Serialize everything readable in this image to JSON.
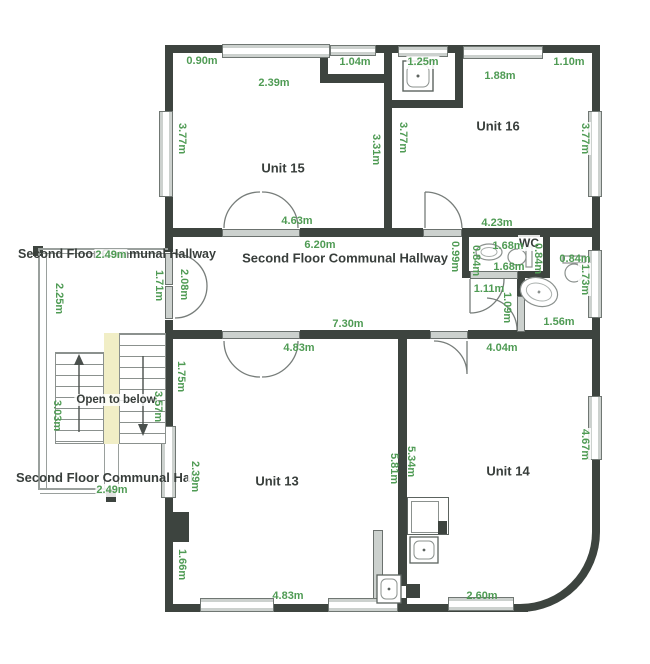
{
  "labels": {
    "unit15": "Unit 15",
    "unit16": "Unit 16",
    "unit13": "Unit 13",
    "unit14": "Unit 14",
    "hallway_main": "Second Floor Communal Hallway",
    "hallway_left_top": "Second Floor Communal Hallway",
    "hallway_left_bottom": "Second Floor Communal Hallway",
    "wc": "WC",
    "open_to_below": "Open to below"
  },
  "measurements": {
    "unit15_top_left": "0.90m",
    "unit15_top_window": "2.39m",
    "unit15_alcove": "1.04m",
    "unit15_left": "3.77m",
    "unit15_right": "3.31m",
    "unit15_door": "4.63m",
    "unit16_alcove": "1.25m",
    "unit16_top_window": "1.88m",
    "unit16_top_right": "1.10m",
    "unit16_left": "3.77m",
    "unit16_right": "3.77m",
    "unit16_bottom": "4.23m",
    "hallway_top": "6.20m",
    "hallway_bottom": "7.30m",
    "annex_top": "2.49m",
    "annex_left": "2.25m",
    "annex_right": "1.71m",
    "annex_door": "2.08m",
    "stairs_left": "3.03m",
    "stairs_right": "3.57m",
    "annex_bottom": "2.49m",
    "wc_outside": "0.99m",
    "wc_top": "1.68m",
    "wc_left": "0.84m",
    "wc_right": "0.84m",
    "wc_bottom": "1.68m",
    "lobby_door": "1.11m",
    "bath_door": "1.09m",
    "bath_top": "0.84m",
    "bath_right": "1.73m",
    "bath_bottom": "1.56m",
    "unit13_door": "4.83m",
    "unit13_wall_upper": "1.75m",
    "unit13_left_window": "2.39m",
    "unit13_right": "5.81m",
    "unit13_wall_lower": "1.66m",
    "unit13_bottom": "4.83m",
    "unit14_top": "4.04m",
    "unit14_left": "5.34m",
    "unit14_right": "4.67m",
    "unit14_bottom": "2.60m"
  },
  "colors": {
    "wall": "#3d443f",
    "measurement_text": "#4f9b54",
    "room_label_text": "#383e3b",
    "fixture_gray": "#ccd1ce",
    "stair_highlight": "#f1eec6"
  }
}
